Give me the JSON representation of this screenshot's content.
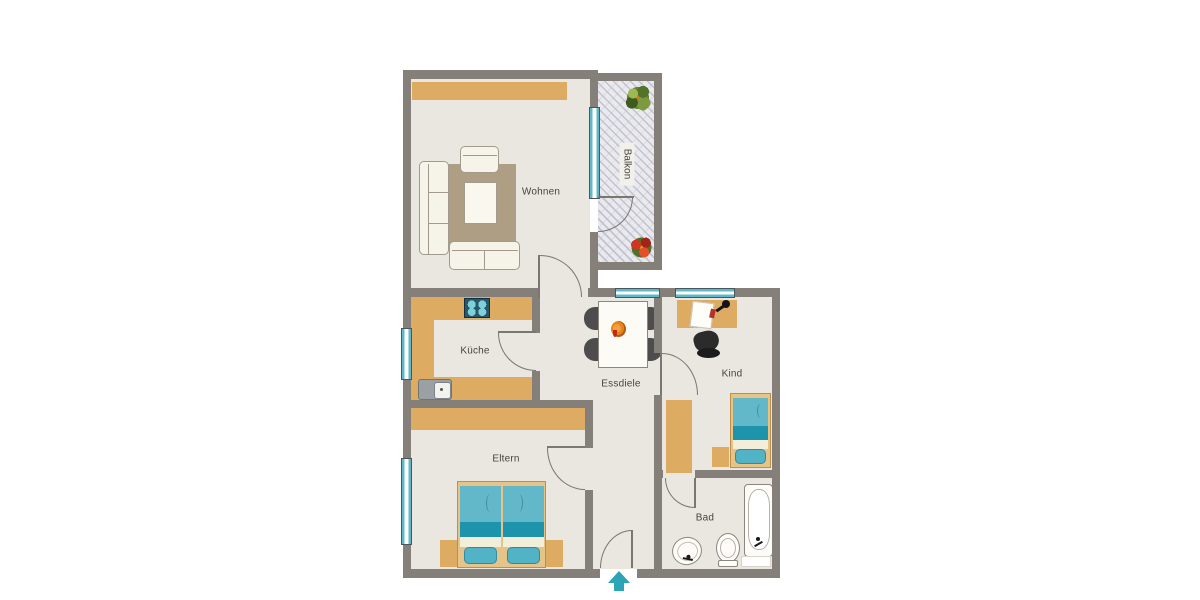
{
  "rooms": {
    "wohnen": {
      "label": "Wohnen"
    },
    "balkon": {
      "label": "Balkon"
    },
    "kueche": {
      "label": "Küche"
    },
    "essdiele": {
      "label": "Essdiele"
    },
    "kind": {
      "label": "Kind"
    },
    "eltern": {
      "label": "Eltern"
    },
    "bad": {
      "label": "Bad"
    }
  },
  "entrance": {
    "indicator": "arrow-up"
  },
  "colors": {
    "wall": "#847f78",
    "floor": "#eae7e0",
    "furniture_tan": "#ddab61",
    "rug": "#ad9e84",
    "sofa_cream": "#f6f3e8",
    "teal_light": "#62b7c9",
    "teal_dark": "#1d93ac",
    "window_teal": "#5fb7c8",
    "arrow_teal": "#2ba4b6",
    "chair_dark": "#4d4d4d",
    "stove_dark": "#24586b",
    "plant_green": "#688833",
    "flower_red": "#d03423"
  },
  "furniture": {
    "wohnen": [
      "sideboard",
      "sofa",
      "armchair",
      "coffee-table",
      "rug"
    ],
    "balkon": [
      "plant",
      "flower"
    ],
    "kueche": [
      "counter",
      "stove",
      "sink"
    ],
    "essdiele": [
      "dining-table",
      "chairs",
      "fruit-bowl"
    ],
    "kind": [
      "desk",
      "desk-lamp",
      "office-chair",
      "bed",
      "nightstand",
      "wardrobe"
    ],
    "eltern": [
      "double-bed",
      "nightstands",
      "wardrobe"
    ],
    "bad": [
      "bathtub",
      "toilet",
      "washbasin",
      "bath-mat"
    ]
  }
}
